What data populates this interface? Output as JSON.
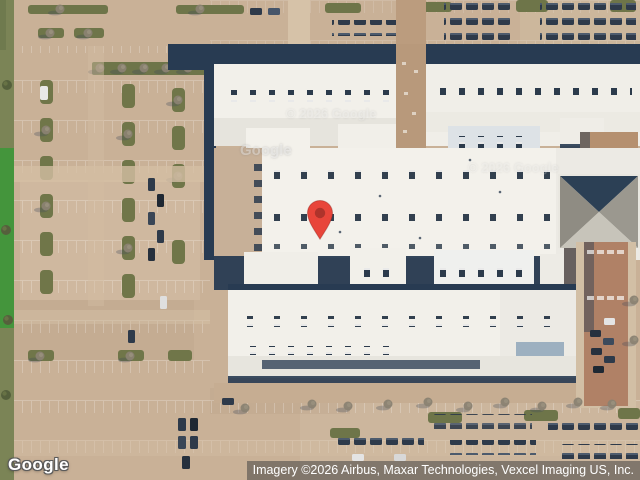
{
  "map": {
    "provider_logo": "Google",
    "attribution": "Imagery ©2026 Airbus, Maxar Technologies, Vexcel Imaging US, Inc.",
    "tile_watermarks": {
      "google": "Google",
      "copyright": "© 2026 Google"
    },
    "marker": {
      "label": "location-pin",
      "color": "#E8453A",
      "inner_color": "#AE332B",
      "outline": "#8E241D"
    },
    "colors": {
      "pavement": "#c9b197",
      "roof_white": "#f2f0ea",
      "building_shadow": "#283b52",
      "vegetation_olive": "#6e7549",
      "grass_green": "#44953c",
      "brick_road": "#b08166",
      "attribution_bg": "rgba(68,68,68,0.55)"
    }
  }
}
